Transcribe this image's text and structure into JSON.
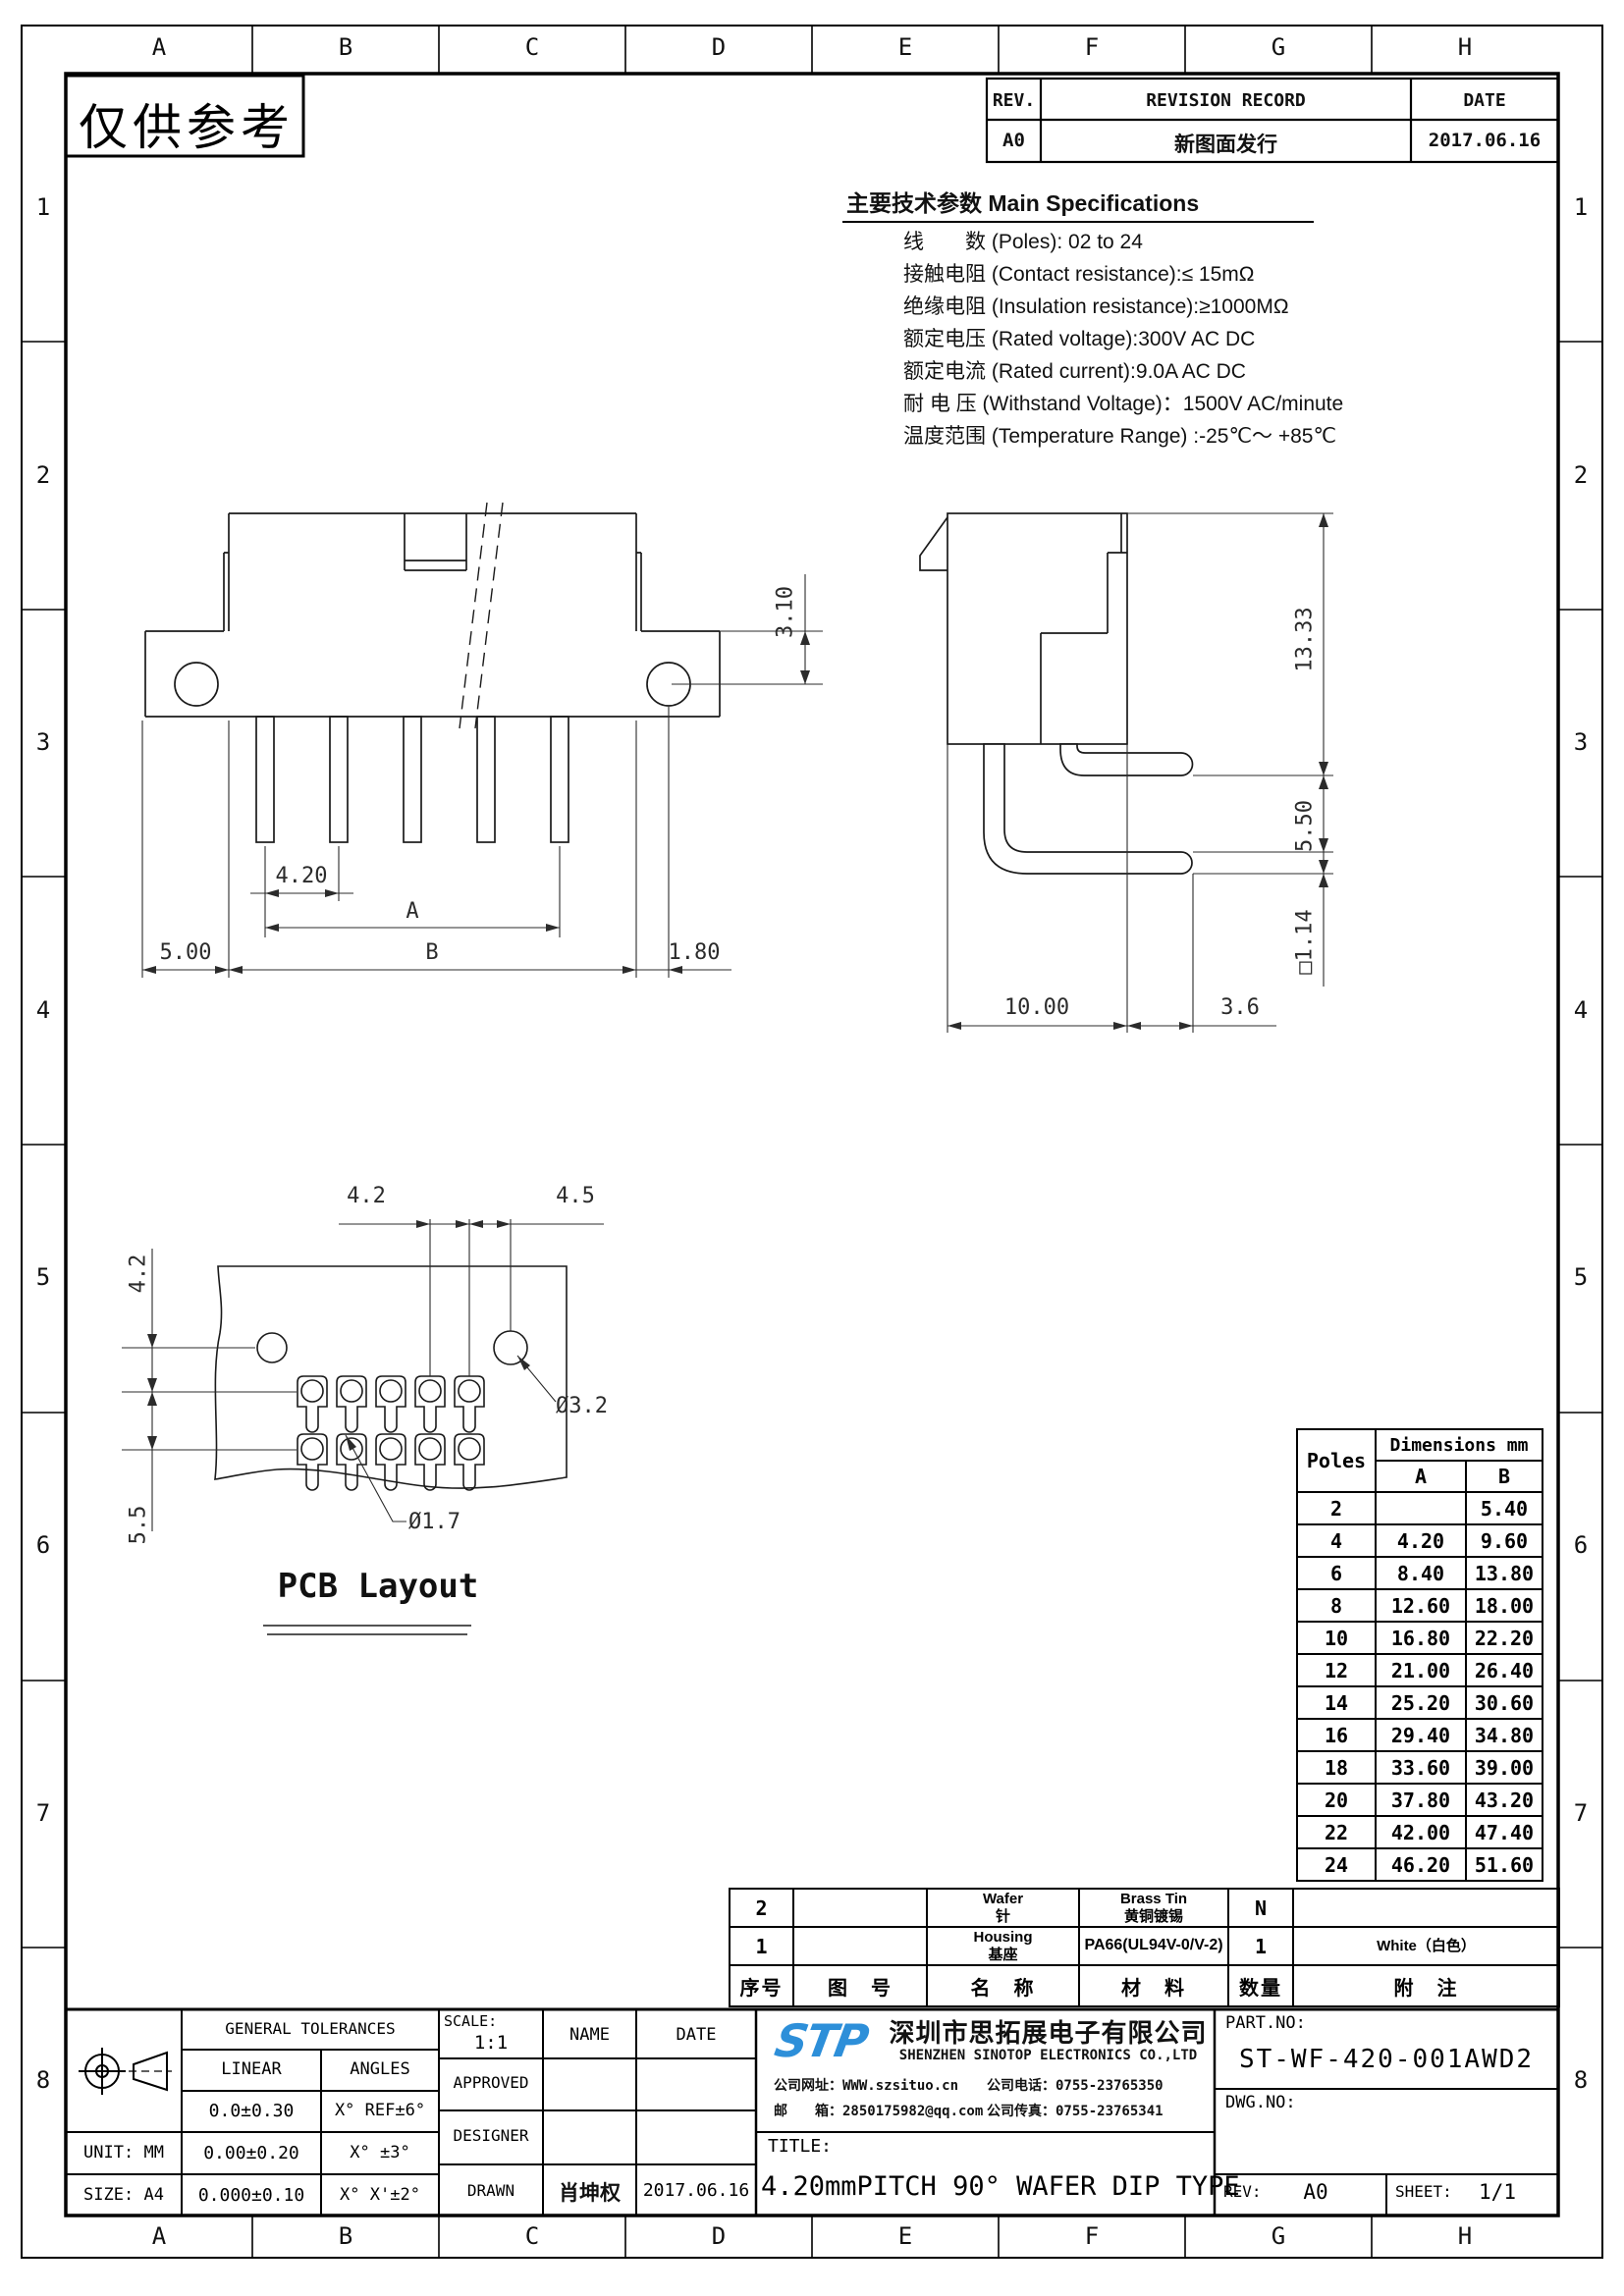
{
  "sheet": {
    "stamp": "仅供参考"
  },
  "frame": {
    "cols": [
      "A",
      "B",
      "C",
      "D",
      "E",
      "F",
      "G",
      "H"
    ],
    "rows": [
      "1",
      "2",
      "3",
      "4",
      "5",
      "6",
      "7",
      "8"
    ]
  },
  "revision": {
    "rev_h": "REV.",
    "record_h": "REVISION RECORD",
    "date_h": "DATE",
    "rev": "A0",
    "record": "新图面发行",
    "date": "2017.06.16"
  },
  "specs": {
    "title": "主要技术参数 Main Specifications",
    "lines": [
      "线　　数 (Poles): 02 to 24",
      "接触电阻 (Contact resistance):≤ 15mΩ",
      "绝缘电阻 (Insulation resistance):≥1000MΩ",
      "额定电压 (Rated voltage):300V AC DC",
      "额定电流 (Rated current):9.0A AC DC",
      "耐 电 压 (Withstand Voltage)：1500V AC/minute",
      "温度范围 (Temperature Range) :-25℃～ +85℃"
    ]
  },
  "views": {
    "front": {
      "d_hole": "3.10",
      "d_pitch": "4.20",
      "d_a": "A",
      "d_5": "5.00",
      "d_b": "B",
      "d_18": "1.80"
    },
    "side": {
      "d_h": "13.33",
      "d_p": "5.50",
      "d_sq": "□1.14",
      "d_10": "10.00",
      "d_36": "3.6"
    },
    "pcb": {
      "title": "PCB Layout",
      "d_top42": "4.2",
      "d_top45": "4.5",
      "d_left42": "4.2",
      "d_left55": "5.5",
      "d_hole": "Ø3.2",
      "d_pad": "Ø1.7"
    }
  },
  "poles_table": {
    "poles_h": "Poles",
    "dims_h": "Dimensions mm",
    "a_h": "A",
    "b_h": "B",
    "rows": [
      {
        "poles": "2",
        "a": "",
        "b": "5.40"
      },
      {
        "poles": "4",
        "a": "4.20",
        "b": "9.60"
      },
      {
        "poles": "6",
        "a": "8.40",
        "b": "13.80"
      },
      {
        "poles": "8",
        "a": "12.60",
        "b": "18.00"
      },
      {
        "poles": "10",
        "a": "16.80",
        "b": "22.20"
      },
      {
        "poles": "12",
        "a": "21.00",
        "b": "26.40"
      },
      {
        "poles": "14",
        "a": "25.20",
        "b": "30.60"
      },
      {
        "poles": "16",
        "a": "29.40",
        "b": "34.80"
      },
      {
        "poles": "18",
        "a": "33.60",
        "b": "39.00"
      },
      {
        "poles": "20",
        "a": "37.80",
        "b": "43.20"
      },
      {
        "poles": "22",
        "a": "42.00",
        "b": "47.40"
      },
      {
        "poles": "24",
        "a": "46.20",
        "b": "51.60"
      }
    ]
  },
  "bom": {
    "headers": {
      "no": "序号",
      "dwg": "图　号",
      "name": "名　称",
      "mat": "材　料",
      "qty": "数量",
      "note": "附　注"
    },
    "rows": [
      {
        "no": "2",
        "dwg": "",
        "name1": "Wafer",
        "name2": "针",
        "mat1": "Brass Tin",
        "mat2": "黄铜镀锡",
        "qty": "N",
        "note": ""
      },
      {
        "no": "1",
        "dwg": "",
        "name1": "Housing",
        "name2": "基座",
        "mat1": "PA66(UL94V-0/V-2)",
        "mat2": "",
        "qty": "1",
        "note": "White（白色）"
      }
    ]
  },
  "titleblock": {
    "tolerances": {
      "header": "GENERAL TOLERANCES",
      "linear": "LINEAR",
      "angles": "ANGLES",
      "rows": [
        {
          "linear": "0.0±0.30",
          "angles": "X° REF±6°"
        },
        {
          "linear": "0.00±0.20",
          "angles": "X° ±3°"
        },
        {
          "linear": "0.000±0.10",
          "angles": "X° X'±2°"
        }
      ],
      "unit": "UNIT: MM",
      "size": "SIZE: A4"
    },
    "scale_label": "SCALE:",
    "scale": "1:1",
    "name_h": "NAME",
    "date_h": "DATE",
    "approved": "APPROVED",
    "designer": "DESIGNER",
    "drawn": "DRAWN",
    "drawn_name": "肖坤权",
    "drawn_date": "2017.06.16",
    "company": {
      "logo": "STP",
      "name_cn": "深圳市思拓展电子有限公司",
      "name_en": "SHENZHEN SINOTOP ELECTRONICS CO.,LTD",
      "web_label": "公司网址：",
      "web": "WWW.szsituo.cn",
      "tel_label": "公司电话：",
      "tel": "0755-23765350",
      "email_label": "邮　　箱：",
      "email": "2850175982@qq.com",
      "fax_label": "公司传真：",
      "fax": "0755-23765341"
    },
    "title_label": "TITLE:",
    "title": "4.20mmPITCH 90° WAFER DIP TYPE",
    "partno_label": "PART.NO:",
    "partno": "ST-WF-420-001AWD2",
    "dwgno_label": "DWG.NO:",
    "rev_label": "REV:",
    "rev": "A0",
    "sheet_label": "SHEET:",
    "sheet": "1/1"
  }
}
